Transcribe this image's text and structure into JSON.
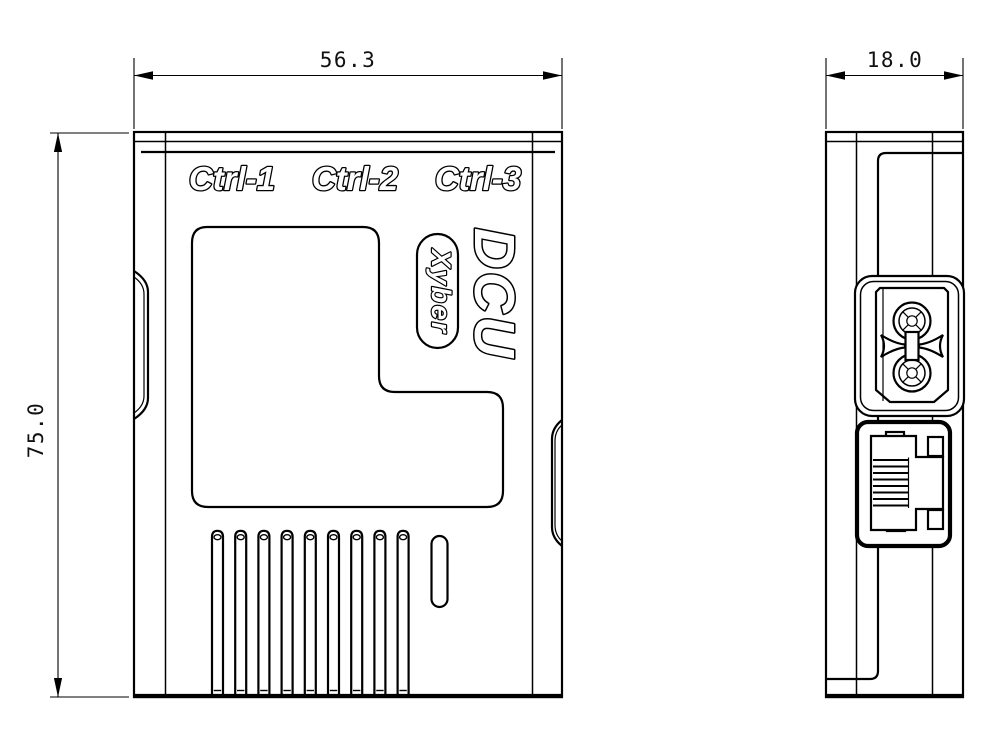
{
  "front_view": {
    "port_labels": [
      "Ctrl-1",
      "Ctrl-2",
      "Ctrl-3"
    ],
    "model": "DCU",
    "brand": "Xyber",
    "width_dim": "56.3",
    "height_dim": "75.0"
  },
  "side_view": {
    "depth_dim": "18.0"
  },
  "colors": {
    "line": "#000000",
    "background": "#ffffff"
  }
}
